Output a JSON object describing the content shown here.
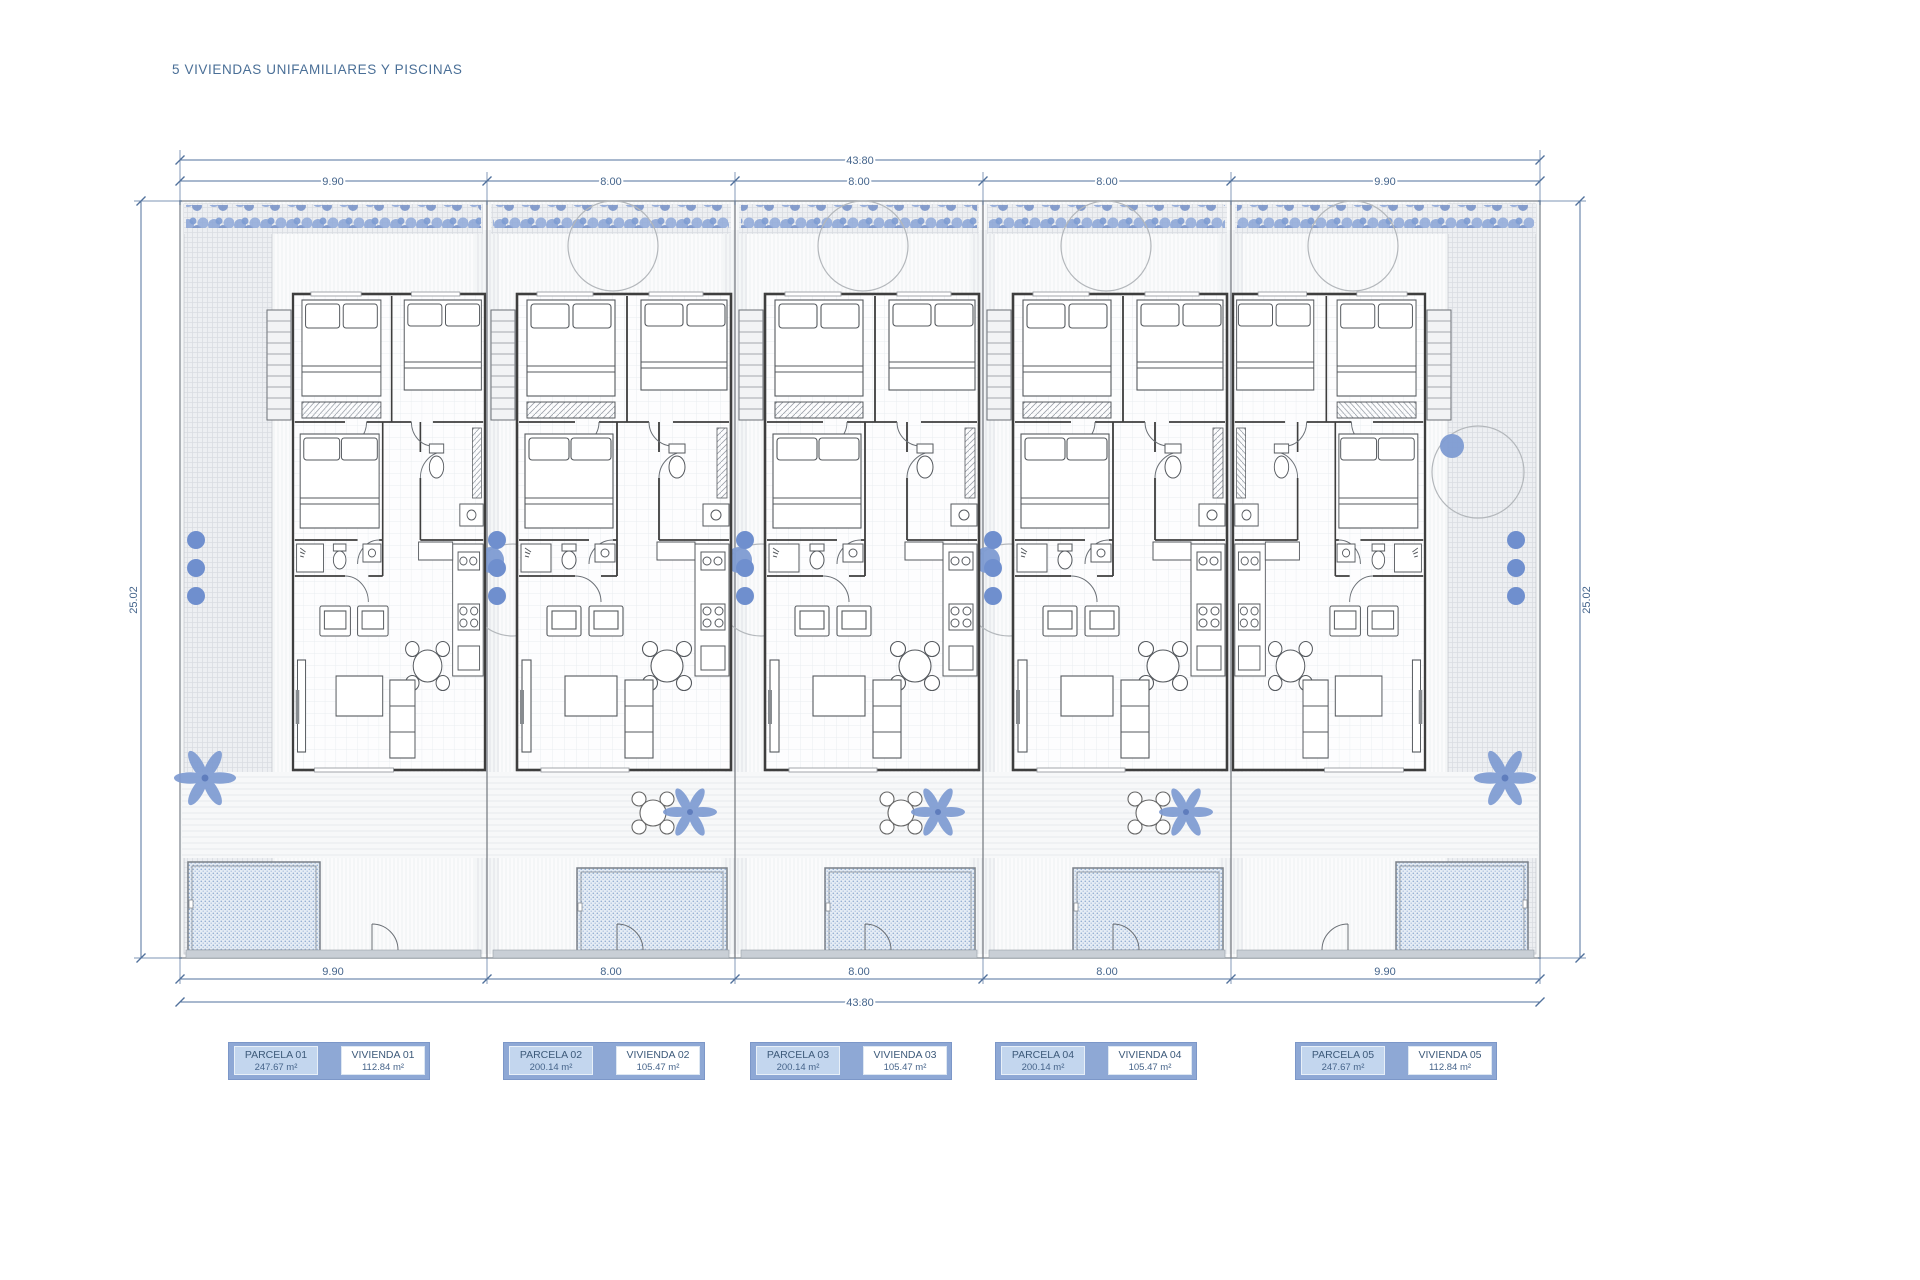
{
  "title": "5 VIVIENDAS UNIFAMILIARES Y PISCINAS",
  "dimensions": {
    "top_total": "43.80",
    "top_segments": [
      "9.90",
      "8.00",
      "8.00",
      "8.00",
      "9.90"
    ],
    "bottom_segments": [
      "9.90",
      "8.00",
      "8.00",
      "8.00",
      "9.90"
    ],
    "bottom_total": "43.80",
    "left_side": "25.02",
    "right_side": "25.02"
  },
  "legend": [
    {
      "parcela_label": "PARCELA 01",
      "parcela_area": "247.67 m²",
      "vivienda_label": "VIVIENDA 01",
      "vivienda_area": "112.84 m²"
    },
    {
      "parcela_label": "PARCELA 02",
      "parcela_area": "200.14 m²",
      "vivienda_label": "VIVIENDA 02",
      "vivienda_area": "105.47 m²"
    },
    {
      "parcela_label": "PARCELA 03",
      "parcela_area": "200.14 m²",
      "vivienda_label": "VIVIENDA 03",
      "vivienda_area": "105.47 m²"
    },
    {
      "parcela_label": "PARCELA 04",
      "parcela_area": "200.14 m²",
      "vivienda_label": "VIVIENDA 04",
      "vivienda_area": "105.47 m²"
    },
    {
      "parcela_label": "PARCELA 05",
      "parcela_area": "247.67 m²",
      "vivienda_label": "VIVIENDA 05",
      "vivienda_area": "112.84 m²"
    }
  ],
  "colors": {
    "title_text": "#4a6f97",
    "dimension": "#51719c",
    "walls": "#3e3e3e",
    "vegetation": "#7e9bd2",
    "bush": "#6f8fce",
    "pool_fill": "#e6edf5",
    "pool_dots": "#93aed2",
    "legend_container": "#8ea8d5",
    "parcela_cell": "#c3d6ee",
    "legend_text": "#3d5a7a"
  }
}
